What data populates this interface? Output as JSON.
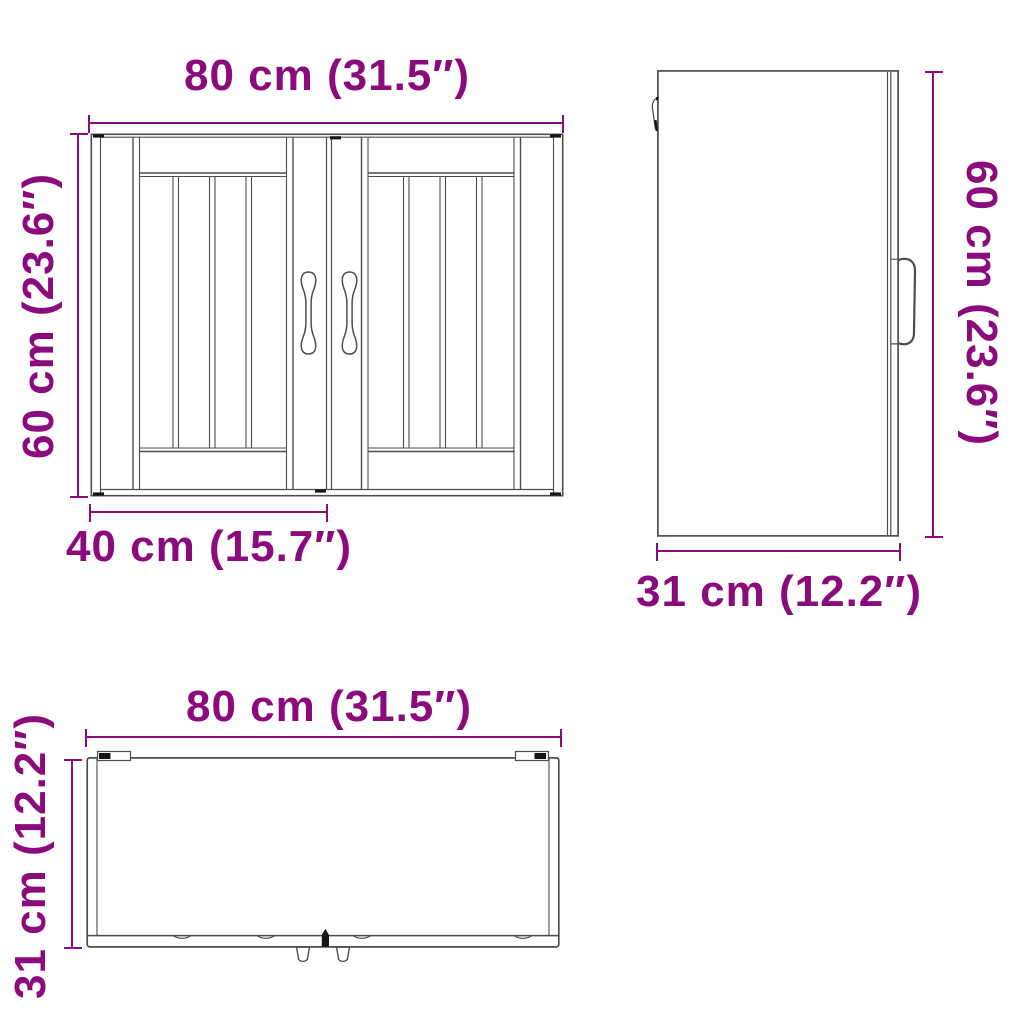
{
  "diagram": {
    "accent_color": "#8C0B7C",
    "line_color": "#4d4d4d",
    "views": {
      "front": {
        "name": "front view of wall cabinet with two slatted doors",
        "width_label": "80 cm (31.5″)",
        "height_label": "60 cm (23.6″)",
        "door_width_label": "40 cm (15.7″)"
      },
      "side": {
        "name": "side view of wall cabinet with door handle",
        "height_label": "60 cm (23.6″)",
        "depth_label": "31 cm (12.2″)"
      },
      "top": {
        "name": "top view of wall cabinet with hinges and knobs",
        "width_label": "80 cm (31.5″)",
        "depth_label": "31 cm (12.2″)"
      }
    }
  }
}
